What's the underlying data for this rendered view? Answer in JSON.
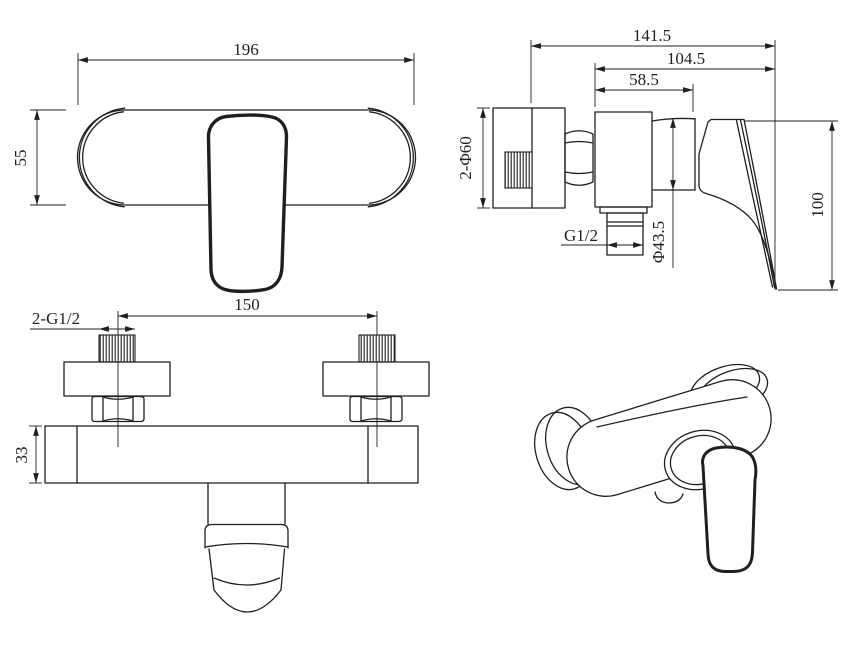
{
  "drawing": {
    "background": "#ffffff",
    "line_color": "#1f1f1f"
  },
  "dimensions": {
    "front_width": "196",
    "front_height": "55",
    "side_total_depth": "141.5",
    "side_body_depth": "104.5",
    "side_valve_depth": "58.5",
    "side_flange": "2-Φ60",
    "side_outlet_thread": "G1/2",
    "side_cartridge_dia": "Φ43.5",
    "side_handle_height": "100",
    "top_inlet_thread": "2-G1/2",
    "top_inlet_spacing": "150",
    "top_body_thickness": "33"
  }
}
